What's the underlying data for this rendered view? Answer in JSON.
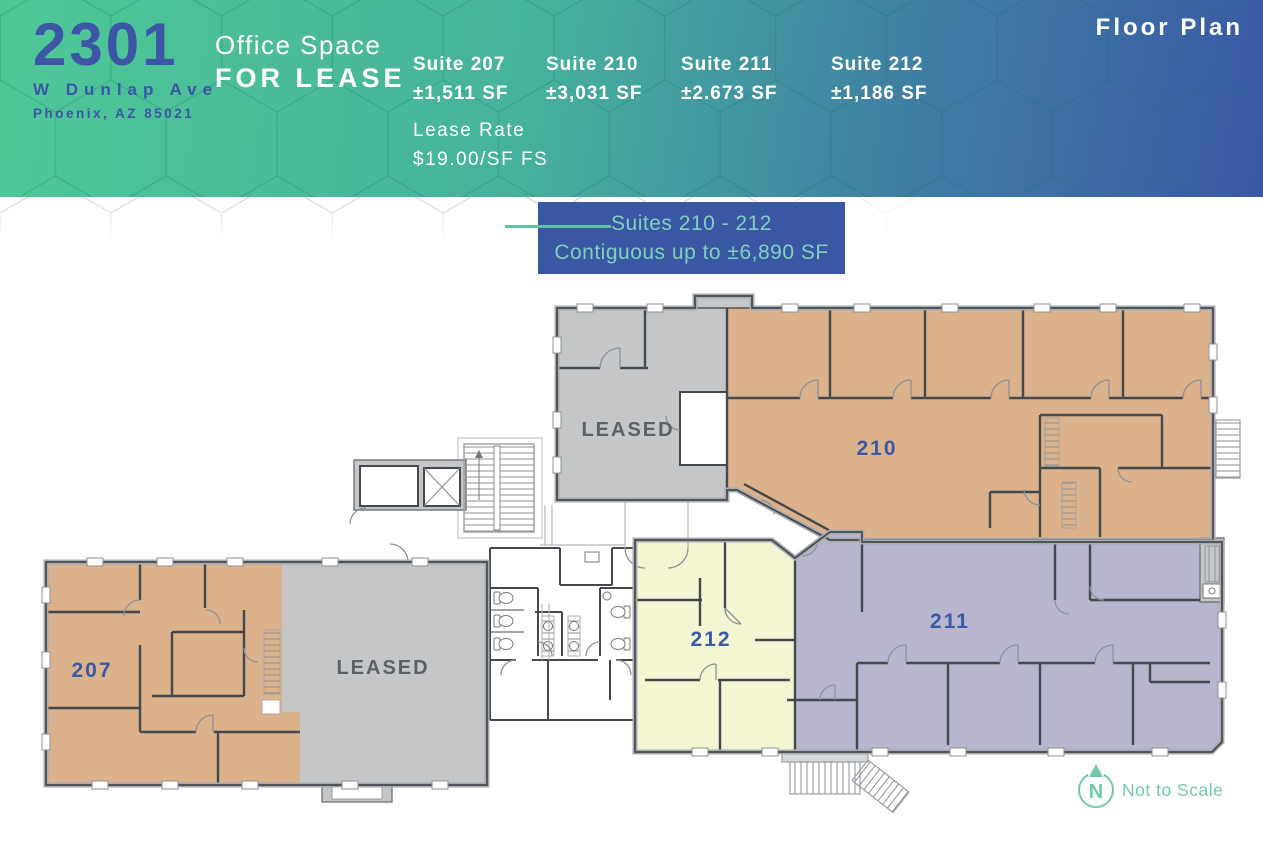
{
  "header": {
    "building_number": "2301",
    "street": "W Dunlap Ave",
    "city": "Phoenix, AZ 85021",
    "offer_line1": "Office Space",
    "offer_line2": "FOR LEASE",
    "plan_title": "Floor Plan",
    "lease_rate_label": "Lease Rate",
    "lease_rate_value": "$19.00/SF FS",
    "suites": [
      {
        "name": "Suite 207",
        "size": "±1,511 SF"
      },
      {
        "name": "Suite 210",
        "size": "±3,031 SF"
      },
      {
        "name": "Suite 211",
        "size": "±2.673 SF"
      },
      {
        "name": "Suite 212",
        "size": "±1,186 SF"
      }
    ]
  },
  "callout": {
    "line1": "Suites 210 - 212",
    "line2": "Contiguous up to ±6,890 SF"
  },
  "plan": {
    "label_207": "207",
    "label_210": "210",
    "label_211": "211",
    "label_212": "212",
    "leased_top": "LEASED",
    "leased_bottom": "LEASED",
    "not_to_scale": "Not to Scale",
    "compass_letter": "N"
  },
  "colors": {
    "header_gradient_start": "#4FC897",
    "header_gradient_end": "#3A58A5",
    "brand_blue": "#3C55A5",
    "callout_bg": "#3A57A3",
    "callout_text": "#7FD0BD",
    "callout_line": "#5FC3A8",
    "suite_207_fill": "#DBB28C",
    "suite_210_fill": "#DBB28C",
    "suite_211_fill": "#B7B6CE",
    "suite_212_fill": "#F3F5D3",
    "leased_fill": "#C5C6C8",
    "suite_label_blue": "#3A5AA8",
    "leased_label_gray": "#5D6166",
    "scale_green": "#6FCBA5"
  }
}
